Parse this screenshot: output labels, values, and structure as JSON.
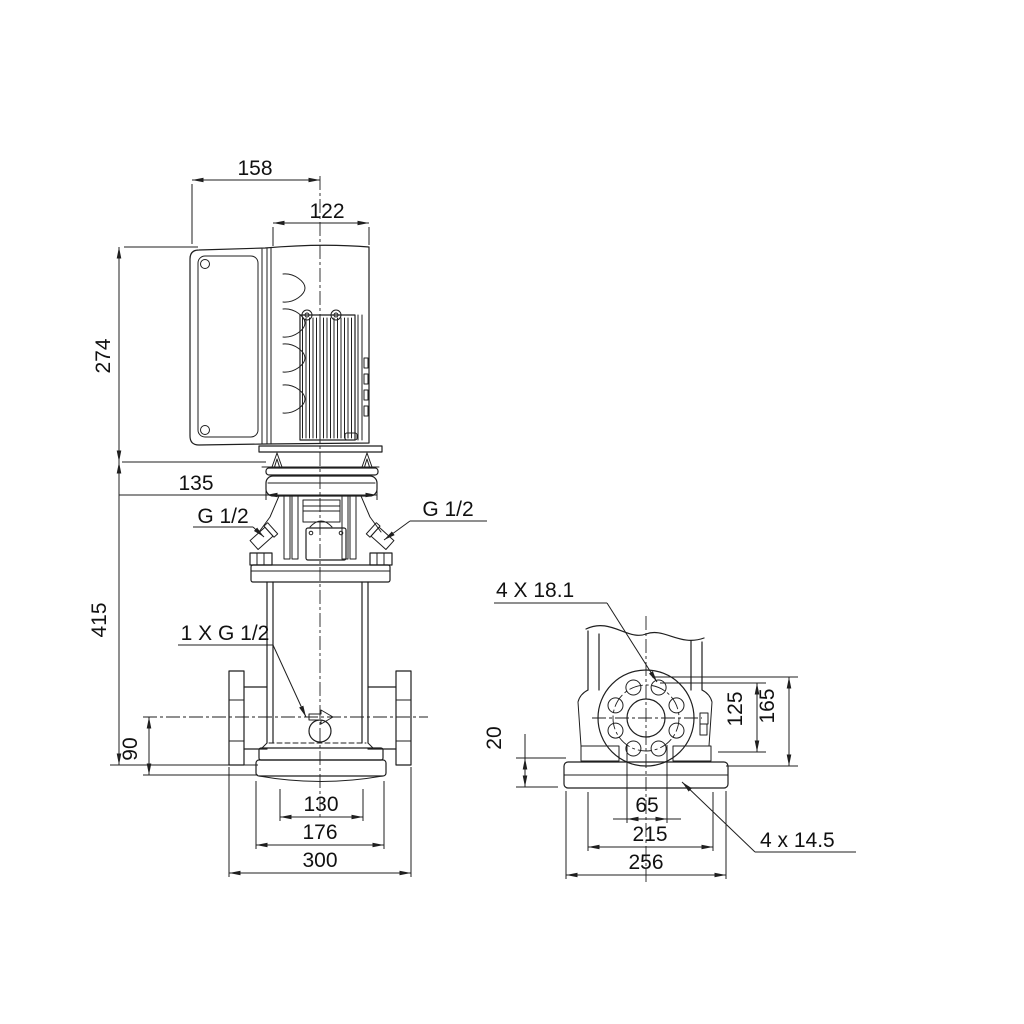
{
  "drawing": {
    "background": "#ffffff",
    "line_color": "#1f1f1f",
    "front_view": {
      "dims": {
        "width_top": "158",
        "width_motor": "122",
        "height_motor": "274",
        "width_head": "135",
        "height_pump": "415",
        "height_port": "90",
        "width_inner": "130",
        "width_base": "176",
        "width_flanges": "300"
      },
      "labels": {
        "plug_left": "G 1/2",
        "plug_right": "G 1/2",
        "drain_plug": "1 X G 1/2"
      }
    },
    "side_view": {
      "dims": {
        "height_base": "20",
        "height_flange_lower": "125",
        "height_flange_upper": "165",
        "width_ports": "65",
        "width_bolt_holes": "215",
        "width_base": "256"
      },
      "labels": {
        "flange_holes": "4 X 18.1",
        "base_holes": "4 x 14.5"
      }
    }
  }
}
